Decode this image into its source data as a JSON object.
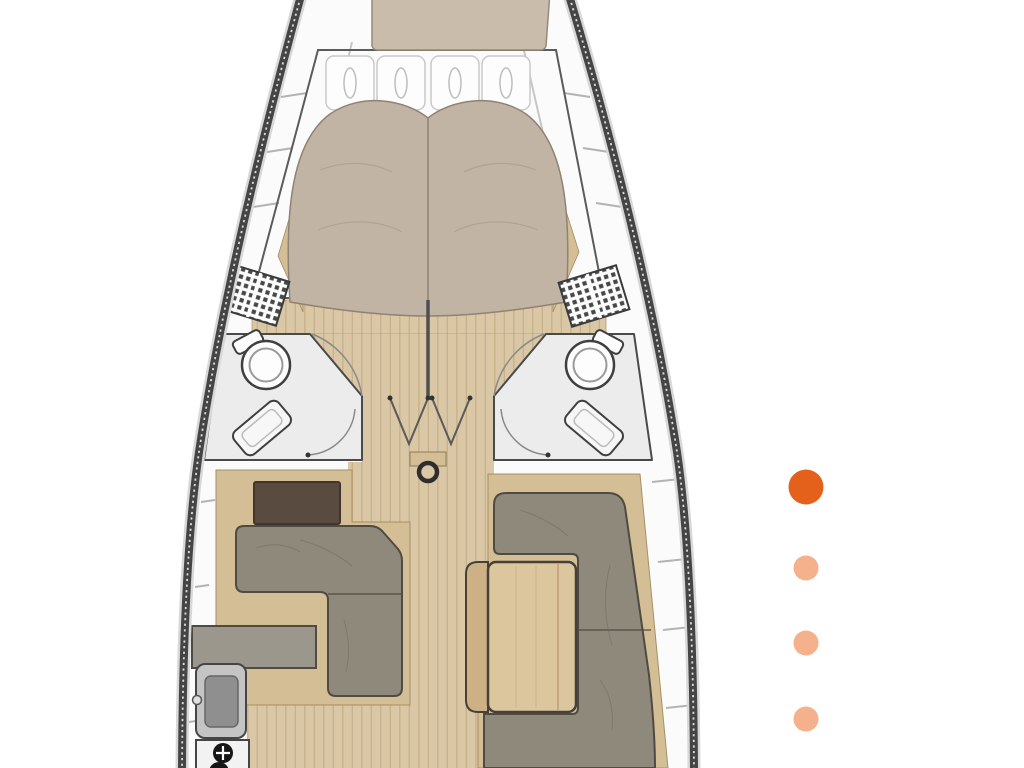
{
  "page": {
    "background": "#ffffff"
  },
  "carousel": {
    "dots": [
      {
        "name": "dot-1",
        "state": "active",
        "color": "#e4611b"
      },
      {
        "name": "dot-2",
        "state": "inactive",
        "color": "#f5b18c"
      },
      {
        "name": "dot-3",
        "state": "inactive",
        "color": "#f5b18c"
      },
      {
        "name": "dot-4",
        "state": "inactive",
        "color": "#f5b18c"
      }
    ],
    "active_color": "#e4611b",
    "inactive_color": "#f5b18c"
  },
  "floorplan": {
    "type": "sailing-yacht-interior-top-view",
    "areas": [
      "bow-cushion",
      "v-berth-double-bed",
      "bed-pillows",
      "port-head-toilet",
      "starboard-head-toilet",
      "port-shower-bench",
      "starboard-shower-bench",
      "port-vent-grate",
      "starboard-vent-grate",
      "cabin-doors",
      "companionway-doors",
      "mast-step",
      "salon-port-l-sofa",
      "chart-table",
      "salon-starboard-u-sofa",
      "salon-table",
      "galley-counter",
      "galley-sink",
      "galley-stove"
    ],
    "colors": {
      "hull": "#454545",
      "deck": "#fbfbfb",
      "floor_wood": "#d9c7a5",
      "floor_line": "#c3ad85",
      "wood_trim": "#d4be96",
      "mattress": "#c2b4a4",
      "cushion": "#c9bcab",
      "pillow": "#fdfdfd",
      "sofa": "#8f897c",
      "table_wood": "#dcc69e",
      "table_leaf": "#cdb184",
      "dark_table": "#594b3f",
      "counter": "#9c978c",
      "bath_floor": "#ececec",
      "vent": "#474747",
      "sink": "#c4c4c4",
      "basin": "#8f8f8f",
      "stove": "#f2f2f2",
      "burner": "#161616"
    }
  }
}
